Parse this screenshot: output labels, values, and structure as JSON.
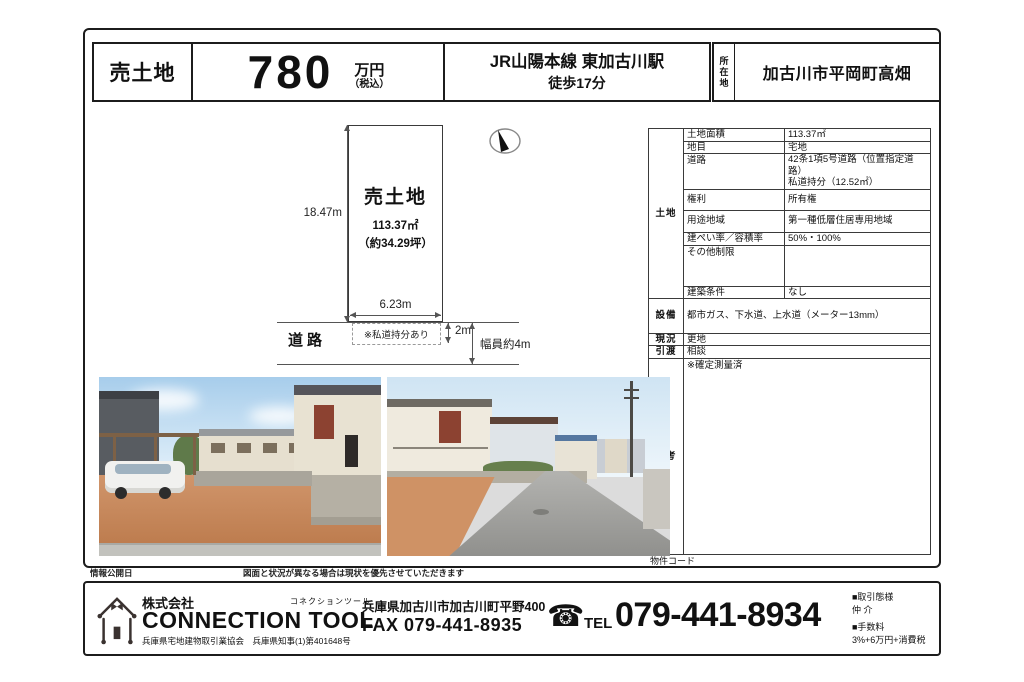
{
  "header": {
    "type_label": "売土地",
    "price_value": "780",
    "price_unit": "万円",
    "price_tax": "（税込）",
    "station_line1": "JR山陽本線 東加古川駅",
    "station_line2": "徒歩17分",
    "location_label": "所在地",
    "address": "加古川市平岡町高畑"
  },
  "diagram": {
    "plot_label": "売土地",
    "plot_area": "113.37㎡",
    "plot_tsubo": "（約34.29坪）",
    "depth": "18.47m",
    "frontage": "6.23m",
    "private_road_note": "※私道持分あり",
    "road_label": "道路",
    "setback": "2m",
    "road_width": "幅員約4m"
  },
  "spec_table": {
    "land_group_label": "土地",
    "rows": [
      {
        "label": "土地面積",
        "value": "113.37㎡"
      },
      {
        "label": "地目",
        "value": "宅地"
      },
      {
        "label": "道路",
        "value": "42条1項5号道路（位置指定道路）\n私道持分（12.52㎡）"
      },
      {
        "label": "権利",
        "value": "所有権"
      },
      {
        "label": "用途地域",
        "value": "第一種低層住居専用地域"
      },
      {
        "label": "建ぺい率／容積率",
        "value": "50%・100%"
      },
      {
        "label": "その他制限",
        "value": ""
      },
      {
        "label": "建築条件",
        "value": "なし"
      }
    ],
    "full_rows": [
      {
        "label": "設備",
        "value": "都市ガス、下水道、上水道（メーター13mm）"
      },
      {
        "label": "現況",
        "value": "更地"
      },
      {
        "label": "引渡",
        "value": "相談"
      },
      {
        "label": "備考",
        "value": "※確定測量済"
      }
    ],
    "property_code_label": "物件コード"
  },
  "strip": {
    "publish_date_label": "情報公開日",
    "disclaimer": "図面と状況が異なる場合は現状を優先させていただきます"
  },
  "footer": {
    "company_prefix": "株式会社",
    "company_name": "CONNECTION TOOL",
    "company_kana": "コネクションツール",
    "license": "兵庫県宅地建物取引業協会　兵庫県知事(1)第401648号",
    "office_address": "兵庫県加古川市加古川町平野400",
    "fax": "FAX 079-441-8935",
    "tel_label": "TEL",
    "tel_number": "079-441-8934",
    "deal_type_label": "■取引態様",
    "deal_type": "仲 介",
    "fee_label": "■手数料",
    "fee": "3%+6万円+消費税"
  },
  "colors": {
    "ink": "#111111",
    "frame": "#1c1c1c",
    "diagram_line": "#555555",
    "photo_sky": "#a7cdeb",
    "photo_dirt": "#c98a58",
    "photo_road": "#9b9b98",
    "shutter_red": "#8c4231"
  }
}
